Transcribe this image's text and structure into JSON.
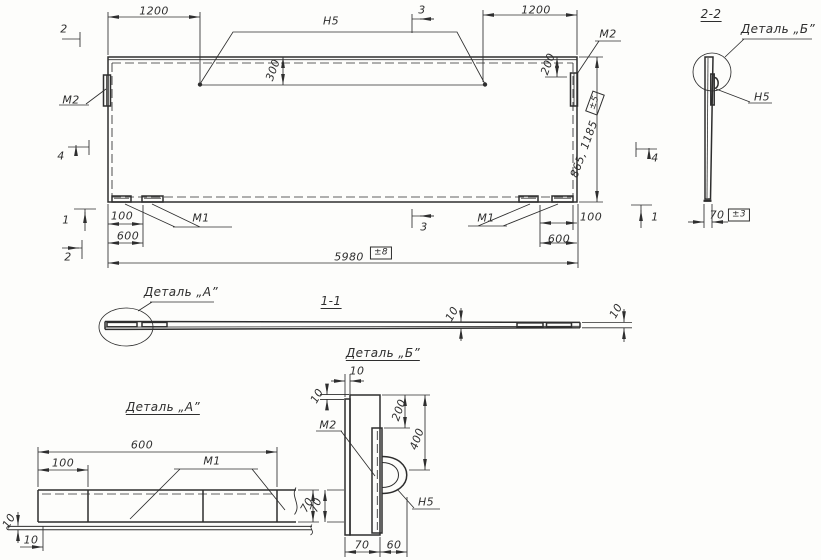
{
  "drawing": {
    "background": "#fdfdfb",
    "ink": "#2e2e2e",
    "main_view": {
      "dims": {
        "top_left": "1200",
        "top_right": "1200",
        "seam_offset": "300",
        "plate_offset": "200",
        "height": "865, 1185",
        "height_tol": "±5",
        "hinge_offset_left": "100",
        "hinge_span_left": "600",
        "hinge_offset_right": "100",
        "hinge_span_right": "600",
        "overall": "5980",
        "overall_tol": "±8"
      },
      "marks": {
        "m1": "М1",
        "m2": "М2",
        "n5": "Н5"
      },
      "sections": {
        "s1": "1",
        "s2": "2",
        "s3": "3",
        "s4": "4"
      }
    },
    "section_2_2": {
      "title": "2-2",
      "detail_callout": "Деталь „Б”",
      "mark_n5": "Н5",
      "dim_width": "70",
      "tol": "±3"
    },
    "section_1_1": {
      "title": "1-1",
      "detail_callout": "Деталь „А”",
      "dim_left": "10",
      "dim_right": "10"
    },
    "detail_a": {
      "title": "Деталь „А”",
      "dim_length": "600",
      "dim_offset": "100",
      "mark": "М1",
      "dim_height": "70",
      "dim_sheet": "10",
      "dim_end": "10"
    },
    "detail_b": {
      "title": "Деталь „Б”",
      "dim_sheet": "10",
      "dim_step": "10",
      "dim_top": "200",
      "dim_loop_center": "400",
      "mark_m2": "М2",
      "mark_n5": "Н5",
      "dim_side": "70",
      "dim_width": "70",
      "dim_loop_width": "60"
    }
  }
}
